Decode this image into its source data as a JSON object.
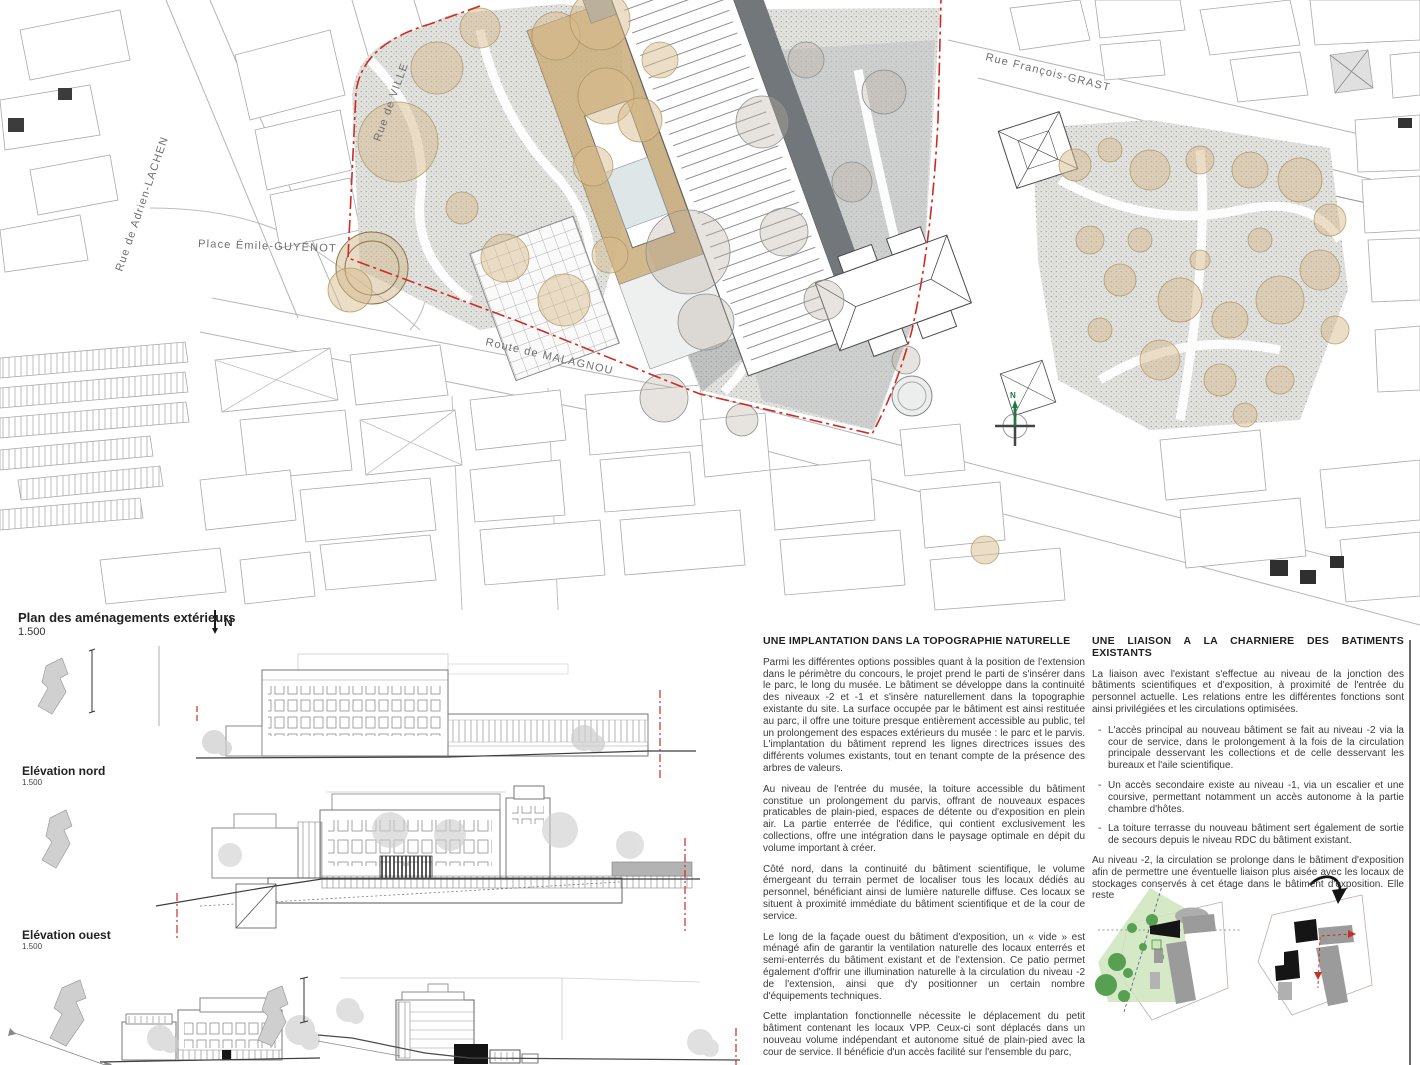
{
  "plan": {
    "title": "Plan des aménagements extérieurs",
    "scale": "1.500",
    "north_label": "N",
    "compass_label": "N"
  },
  "streets": {
    "adrien_lachenal": "Rue de Adrien-LACHEN",
    "villereuse": "Rue de VILLE",
    "francois_grast": "Rue François-GRAST",
    "place_emile_guyenot": "Place Émile-GUYÉNOT",
    "route_malagnou": "Route de MALAGNOU"
  },
  "elevations": {
    "nord": {
      "label": "Elévation nord",
      "scale": "1.500"
    },
    "ouest": {
      "label": "Elévation ouest",
      "scale": "1.500"
    }
  },
  "list_marker": "-",
  "columns": {
    "left": {
      "heading": "UNE IMPLANTATION DANS LA TOPOGRAPHIE NATURELLE",
      "paragraphs": [
        "Parmi les différentes options possibles quant à la position de l'extension dans le périmètre du concours, le projet prend le parti de s'insérer dans le parc, le long du musée. Le bâtiment se développe dans la continuité des niveaux -2 et -1 et s'insère naturellement dans la topographie existante du site. La surface occupée par le bâtiment est ainsi restituée au parc, il offre une toiture presque entièrement accessible au public, tel un prolongement des espaces extérieurs du musée : le parc et le parvis. L'implantation du bâtiment reprend les lignes directrices issues des différents volumes existants, tout en tenant compte de la présence des arbres de valeurs.",
        "Au niveau de l'entrée du musée, la toiture accessible du bâtiment constitue un prolongement du parvis, offrant de nouveaux espaces praticables de plain-pied, espaces de détente ou d'exposition en plein air. La partie enterrée de l'édifice, qui contient exclusivement les collections, offre une intégration dans le paysage optimale en dépit du volume important à créer.",
        "Côté nord, dans la continuité du bâtiment scientifique, le volume émergeant du terrain permet de localiser tous les locaux dédiés au personnel, bénéficiant ainsi de lumière naturelle diffuse. Ces locaux se situent à proximité immédiate du bâtiment scientifique et de la cour de service.",
        "Le long de la façade ouest du bâtiment d'exposition, un « vide » est ménagé afin de garantir la ventilation naturelle des locaux enterrés et semi-enterrés du bâtiment existant et de l'extension. Ce patio permet également d'offrir une illumination naturelle à la circulation du niveau -2 de l'extension, ainsi que d'y positionner un certain nombre d'équipements techniques.",
        "Cette implantation fonctionnelle nécessite le déplacement du petit bâtiment contenant les locaux VPP. Ceux-ci sont déplacés dans un nouveau volume indépendant et autonome situé de plain-pied avec la cour de service. Il bénéficie d'un accès facilité sur l'ensemble du parc,"
      ]
    },
    "right": {
      "heading": "UNE LIAISON A LA CHARNIERE DES BATIMENTS EXISTANTS",
      "intro": "La liaison avec l'existant s'effectue au niveau de la jonction des bâtiments scientifiques et d'exposition, à proximité de l'entrée du personnel actuelle. Les relations entre les différentes fonctions sont ainsi privilégiées et les circulations optimisées.",
      "bullets": [
        "L'accès principal au nouveau bâtiment se fait au niveau -2 via la cour de service, dans le prolongement à la fois de la circulation principale desservant les collections et de celle desservant les bureaux et l'aile scientifique.",
        "Un accès secondaire existe au niveau -1, via un escalier et une coursive, permettant notamment un accès autonome à la partie chambre d'hôtes.",
        "La toiture terrasse du nouveau bâtiment sert également de sortie de secours depuis le niveau RDC du bâtiment existant."
      ],
      "outro": "Au niveau -2, la circulation se prolonge dans le bâtiment d'exposition afin de permettre une éventuelle liaison plus aisée avec les locaux de stockages conservés à cet étage dans le bâtiment d'exposition. Elle reste"
    }
  }
}
